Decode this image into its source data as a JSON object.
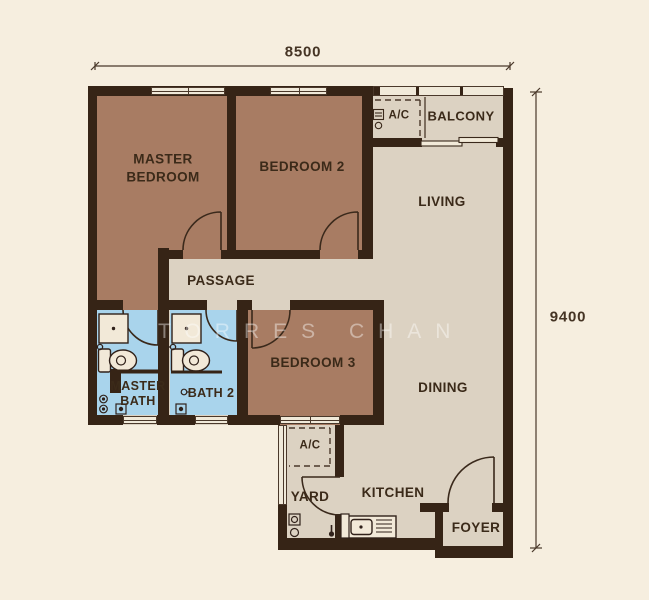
{
  "floorplan": {
    "type": "apartment-floor-plan",
    "dimensions": {
      "width_label": "8500",
      "height_label": "9400"
    },
    "watermark": "TORRES CHAN",
    "rooms": {
      "master_bedroom": "MASTER\nBEDROOM",
      "bedroom_2": "BEDROOM 2",
      "bedroom_3": "BEDROOM 3",
      "master_bath": "MASTER\nBATH",
      "bath_2": "BATH 2",
      "passage": "PASSAGE",
      "living": "LIVING",
      "dining": "DINING",
      "kitchen": "KITCHEN",
      "yard": "YARD",
      "foyer": "FOYER",
      "balcony": "BALCONY",
      "ac_upper": "A/C",
      "ac_lower": "A/C"
    },
    "fixtures": [
      "shower",
      "toilet",
      "kitchen-sink",
      "washer-point",
      "floor-trap",
      "aircond-ledge"
    ],
    "colors": {
      "background": "#f6eedf",
      "wall": "#362416",
      "floor_common": "#dcd2c2",
      "floor_bedroom": "#a87c63",
      "floor_bath": "#a9d4ec",
      "window": "#f0e9d9",
      "text": "#3b2a19"
    }
  }
}
